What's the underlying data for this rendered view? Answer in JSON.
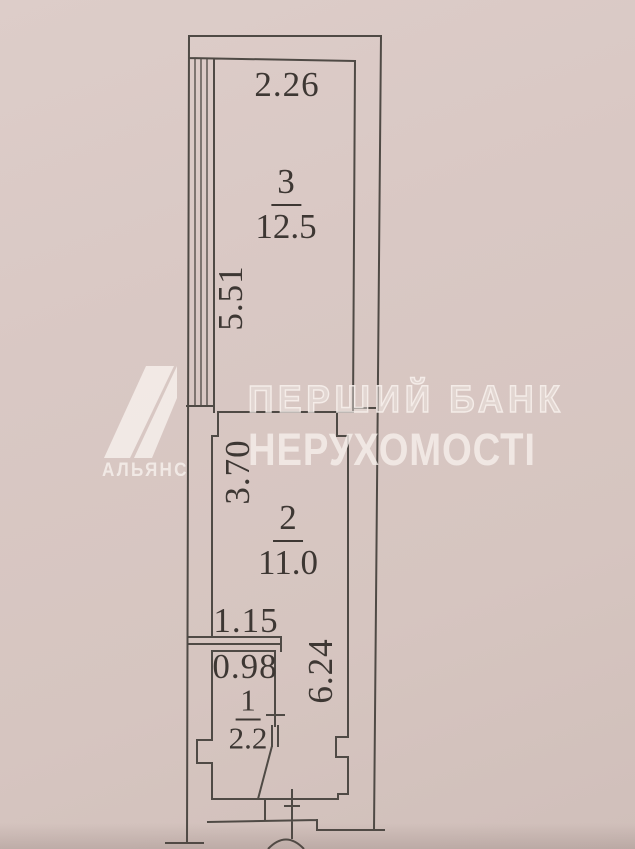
{
  "document_type": "apartment floor plan photo",
  "plan": {
    "rooms": [
      {
        "number": "3",
        "area": "12.5"
      },
      {
        "number": "2",
        "area": "11.0"
      },
      {
        "number": "1",
        "area": "2.2"
      }
    ],
    "dimensions": {
      "room3_width": "2.26",
      "room3_depth": "5.51",
      "room2_depth": "3.70",
      "hall_width": "1.15",
      "room1_width": "0.98",
      "corridor_depth": "6.24"
    }
  },
  "watermark": {
    "brand": "АЛЬЯНС",
    "bank_line1": "ПЕРШИЙ БАНК",
    "bank_line2": "НЕРУХОМОСТІ"
  },
  "colors": {
    "paper": "#d8c7c3",
    "wall_line": "#4f4a45",
    "ink": "#3d3733",
    "watermark": "#f4ede9"
  }
}
